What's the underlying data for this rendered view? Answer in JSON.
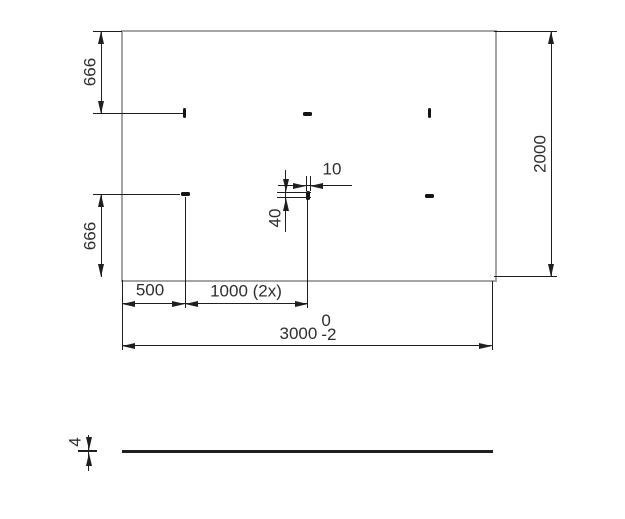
{
  "colors": {
    "line": "#1f1f1f",
    "edge": "#a5a5a5",
    "slot": "#141414",
    "text": "#2e2e2e",
    "background": "#ffffff"
  },
  "drawing": {
    "plan_view": {
      "dim_left_top": "666",
      "dim_left_bottom": "666",
      "dim_right_height": "2000",
      "dim_bottom_first": "500",
      "dim_bottom_pitch": "1000 (2x)",
      "dim_overall": "3000",
      "dim_overall_tol_upper": "0",
      "dim_overall_tol_lower": "-2",
      "dim_slot_width": "10",
      "dim_slot_length": "40"
    },
    "side_view": {
      "dim_thickness": "4"
    }
  }
}
